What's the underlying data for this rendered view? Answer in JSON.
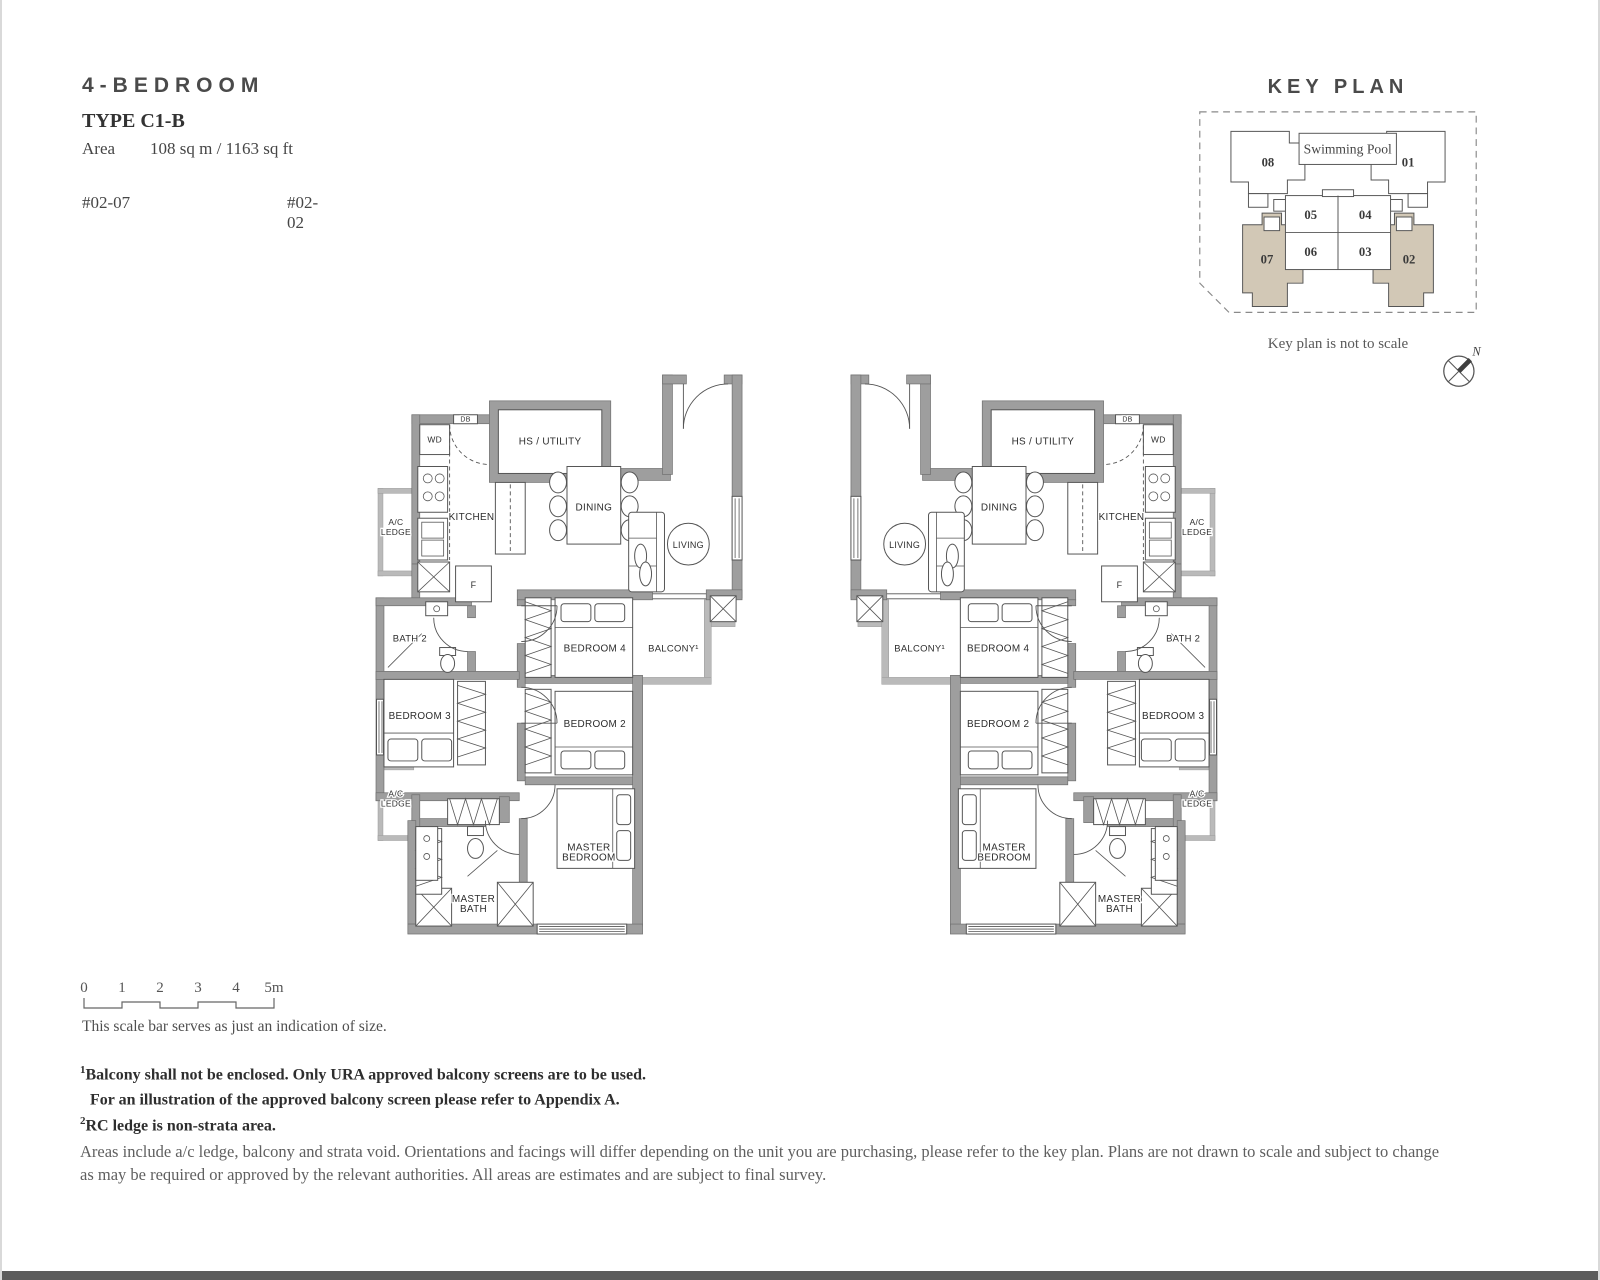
{
  "title_block": {
    "category": "4-BEDROOM",
    "type_label": "TYPE C1-B",
    "area_label": "Area",
    "area_value": "108 sq m / 1163 sq ft",
    "unit_left": "#02-07",
    "unit_right": "#02-02"
  },
  "key_plan": {
    "title": "KEY PLAN",
    "pool_label": "Swimming Pool",
    "note": "Key plan is not to scale",
    "north_label": "N",
    "highlight_color": "#d2c8b6",
    "units": [
      {
        "no": "08",
        "highlight": false
      },
      {
        "no": "01",
        "highlight": false
      },
      {
        "no": "05",
        "highlight": false
      },
      {
        "no": "04",
        "highlight": false
      },
      {
        "no": "06",
        "highlight": false
      },
      {
        "no": "03",
        "highlight": false
      },
      {
        "no": "07",
        "highlight": true
      },
      {
        "no": "02",
        "highlight": true
      }
    ]
  },
  "floorplan": {
    "labels": [
      {
        "text": "DB",
        "x": 94,
        "y": 51,
        "size": 7
      },
      {
        "text": "WD",
        "x": 63,
        "y": 72,
        "size": 8.5
      },
      {
        "text": "HS / UTILITY",
        "x": 179,
        "y": 74
      },
      {
        "text": "KITCHEN",
        "x": 100,
        "y": 150
      },
      {
        "text": "DINING",
        "x": 223,
        "y": 140
      },
      {
        "text": "LIVING",
        "x": 318,
        "y": 178,
        "size": 9
      },
      {
        "lines": [
          "A/C",
          "LEDGE"
        ],
        "x": 24,
        "y": 155,
        "size": 8.5
      },
      {
        "text": "F",
        "x": 102,
        "y": 218,
        "size": 9
      },
      {
        "text": "BATH 2",
        "x": 38,
        "y": 272,
        "size": 9.5
      },
      {
        "text": "BEDROOM 4",
        "x": 224,
        "y": 282
      },
      {
        "text": "BALCONY¹",
        "x": 303,
        "y": 282,
        "size": 9.5
      },
      {
        "text": "BEDROOM 3",
        "x": 48,
        "y": 350
      },
      {
        "text": "BEDROOM 2",
        "x": 224,
        "y": 358
      },
      {
        "lines": [
          "A/C",
          "LEDGE"
        ],
        "x": 24,
        "y": 428,
        "size": 8.5
      },
      {
        "lines": [
          "MASTER",
          "BEDROOM"
        ],
        "x": 218,
        "y": 482
      },
      {
        "lines": [
          "MASTER",
          "BATH"
        ],
        "x": 102,
        "y": 534
      }
    ]
  },
  "scale_bar": {
    "ticks": [
      "0",
      "1",
      "2",
      "3",
      "4",
      "5m"
    ],
    "caption": "This scale bar serves as just an indication of size."
  },
  "footnotes": [
    {
      "sup": "1",
      "text": "Balcony shall not be enclosed. Only URA approved balcony screens are to be used."
    },
    {
      "sup": "",
      "text": "For an illustration of the approved balcony screen please refer to Appendix A."
    },
    {
      "sup": "2",
      "text": "RC ledge is non-strata area."
    }
  ],
  "disclaimer": "Areas include a/c ledge, balcony and strata void. Orientations and facings will differ depending on the unit you are purchasing, please refer to the key plan. Plans are not drawn to scale and subject to change as may be required or approved by the relevant authorities. All areas are estimates and are subject to final survey."
}
